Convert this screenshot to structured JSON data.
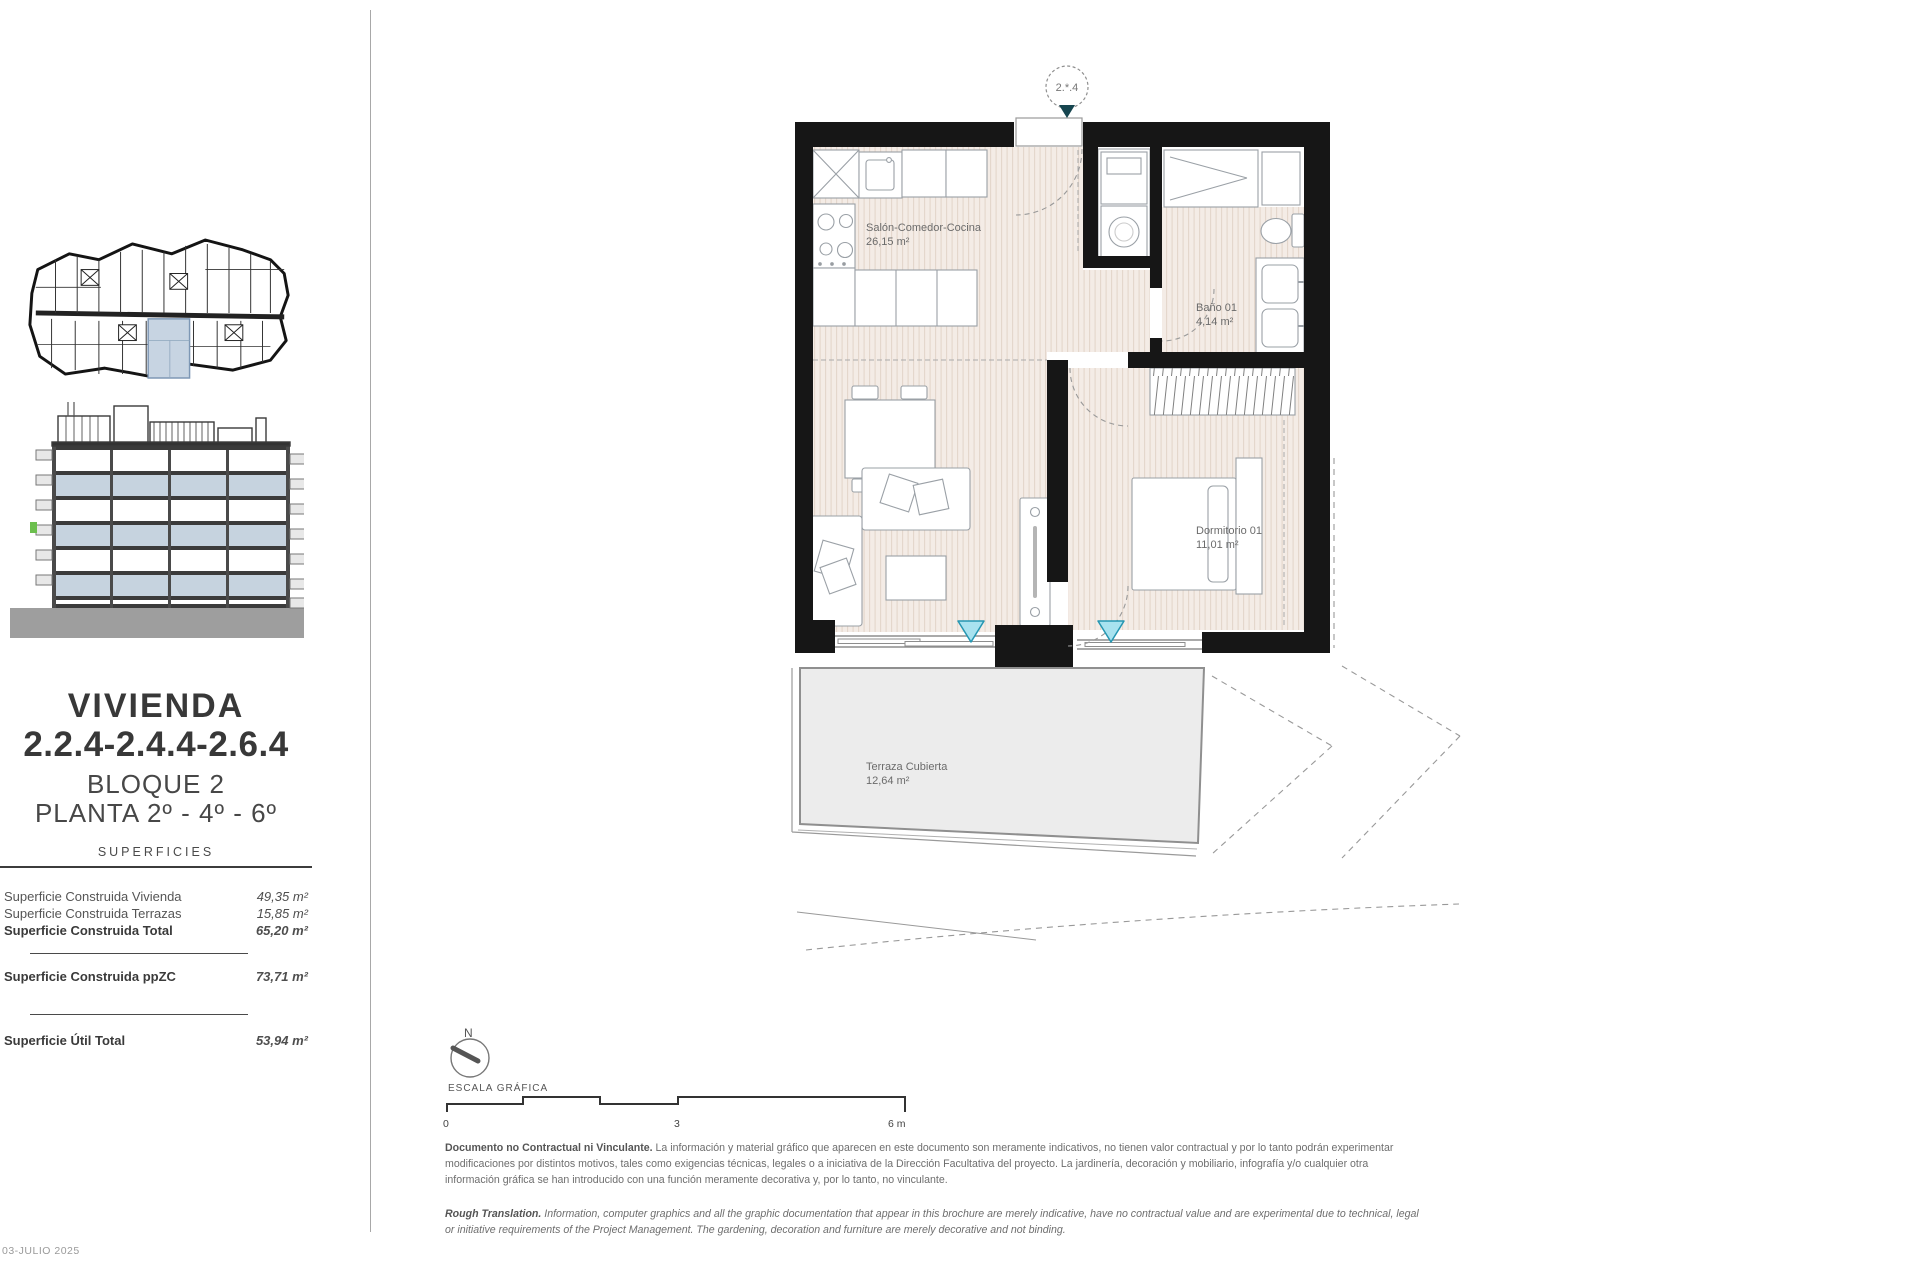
{
  "sidebar": {
    "title": "VIVIENDA",
    "unit_numbers": "2.2.4-2.4.4-2.6.4",
    "block": "BLOQUE 2",
    "floor": "PLANTA 2º - 4º - 6º",
    "surfaces_heading": "SUPERFICIES",
    "surfaces": [
      {
        "label": "Superficie Construida Vivienda",
        "value": "49,35 m²"
      },
      {
        "label": "Superficie Construida Terrazas",
        "value": "15,85 m²"
      },
      {
        "label": "Superficie Construida Total",
        "value": "65,20 m²"
      },
      {
        "label": "Superficie Construida ppZC",
        "value": "73,71 m²"
      },
      {
        "label": "Superficie Útil Total",
        "value": "53,94 m²"
      }
    ]
  },
  "plan": {
    "unit_ref": "2.*.4",
    "rooms": {
      "salon": {
        "name": "Salón-Comedor-Cocina",
        "area": "26,15 m²"
      },
      "bano": {
        "name": "Baño 01",
        "area": "4,14 m²"
      },
      "dormitorio": {
        "name": "Dormitorio 01",
        "area": "11,01 m²"
      },
      "terraza": {
        "name": "Terraza Cubierta",
        "area": "12,64 m²"
      }
    }
  },
  "scale": {
    "north_label": "N",
    "heading": "ESCALA GRÁFICA",
    "tick_0": "0",
    "tick_3": "3",
    "tick_6": "6 m"
  },
  "disclaimer": {
    "es_title": "Documento no Contractual ni Vinculante.",
    "es_body": " La información y material gráfico que aparecen en este documento son meramente indicativos, no tienen valor contractual y por lo tanto podrán experimentar modificaciones por distintos motivos, tales como exigencias técnicas, legales o a iniciativa de la Dirección Facultativa del proyecto. La jardinería, decoración y mobiliario, infografía y/o cualquier otra información gráfica se han introducido con una función meramente decorativa y, por lo tanto, no vinculante.",
    "en_title": "Rough Translation.",
    "en_body": " Information, computer graphics and all the graphic documentation that appear in this brochure are merely indicative, have no contractual value and are experimental due to technical, legal or initiative requirements of the Project Management. The gardening, decoration and furniture are merely decorative and not binding."
  },
  "footer": {
    "date": "03-JULIO 2025"
  },
  "colors": {
    "wall": "#161616",
    "floor_hatch": "#f4ece6",
    "terrace_fill": "#ececec",
    "highlight_blue": "#c7d4e2",
    "marker_teal": "#2496b2",
    "entrance_marker": "#16454f"
  }
}
